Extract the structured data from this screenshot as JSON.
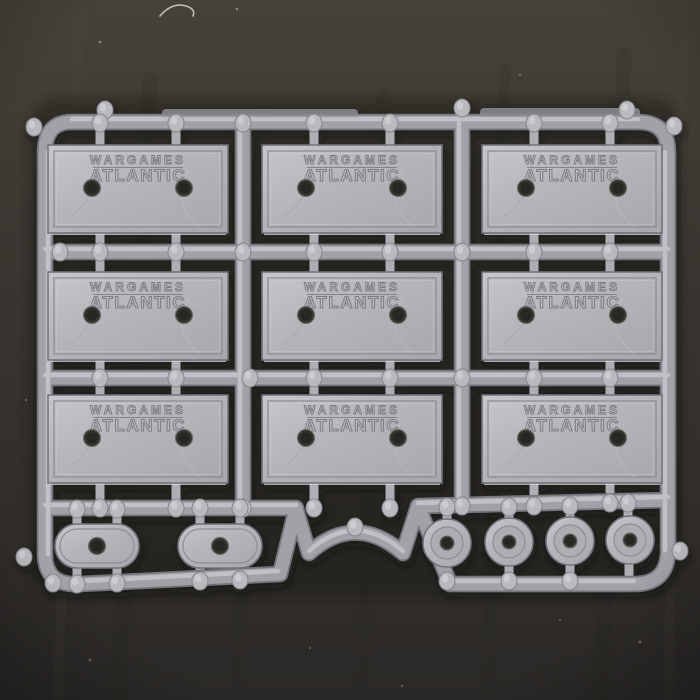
{
  "scene": {
    "description": "Photograph of a grey plastic injection-molded sprue of wargaming miniature bases lying on a dark worn tabletop",
    "object": "Wargames Atlantic bases sprue",
    "background": "dark textured surface"
  },
  "brand": {
    "line1": "WARGAMES",
    "line2": "ATLANTIC"
  },
  "counts": {
    "rectangular_bases": 9,
    "oval_bases": 2,
    "round_bases": 4,
    "grid": "3 x 3 rectangles, bottom row of 2 ovals and 4 rounds"
  },
  "features": {
    "rectangular_base": "embossed brand text with underline and two round peg holes",
    "oval_base": "pill shaped with one central peg hole",
    "round_base": "raised outer ring, inner disc, one central peg hole",
    "sprue": "rounded rectangular runner frame with cross runners, gate tabs and round moulding nubs, arched cut-out at bottom centre"
  },
  "colors": {
    "sprue_body": "#a1a1a7",
    "sprue_edge": "#75757c",
    "sprue_highlight": "#cbcbd0",
    "plate": "#b6b6ba",
    "hole": "#33312e",
    "background_top": "#474239",
    "background_bottom": "#2b2927"
  }
}
